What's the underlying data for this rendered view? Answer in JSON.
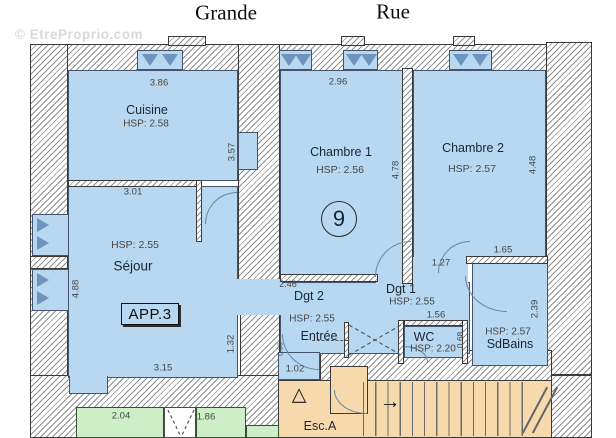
{
  "watermark": "© EtreProprio.com",
  "streets": {
    "left": "Grande",
    "right": "Rue"
  },
  "unit": {
    "app_label": "APP.3",
    "number": "9"
  },
  "rooms": {
    "cuisine": {
      "name": "Cuisine",
      "hsp": "HSP: 2.58"
    },
    "sejour": {
      "name": "Séjour",
      "hsp": "HSP: 2.55"
    },
    "chambre1": {
      "name": "Chambre 1",
      "hsp": "HSP: 2.56"
    },
    "chambre2": {
      "name": "Chambre 2",
      "hsp": "HSP: 2.57"
    },
    "dgt2": {
      "name": "Dgt 2",
      "hsp": "HSP: 2.55"
    },
    "dgt1": {
      "name": "Dgt 1",
      "hsp": "HSP: 2.55"
    },
    "entree": {
      "name": "Entrée"
    },
    "wc": {
      "name": "WC",
      "hsp": "HSP: 2.20"
    },
    "sdbains": {
      "name": "SdBains",
      "hsp": "HSP: 2.57"
    },
    "escalier": {
      "name": "Esc.A"
    }
  },
  "dimensions": {
    "cuisine_width": "3.86",
    "cuisine_depth": "3.57",
    "sejour_top_width": "3.01",
    "sejour_height": "4.88",
    "sejour_bottom_width": "3.15",
    "sejour_right": "1.32",
    "chambre1_width": "2.96",
    "chambre1_height": "4.78",
    "chambre2_height": "4.48",
    "dgt2_width": "2.46",
    "dgt1_wall": "1.27",
    "sdbains_width": "1.65",
    "wc_width": "1.56",
    "wc_right": "0.68",
    "sdbains_height": "2.39",
    "entree_bottom": "1.02",
    "entree_door": "0.96",
    "annex_left_width": "2.04",
    "annex_right_width": "1.86"
  },
  "icons": {
    "stair_arrow": "→",
    "stair_start": "△"
  },
  "colors": {
    "room_fill": "#b8d7f0",
    "annex_fill": "#cdeec6",
    "stair_fill": "#f7d9ae",
    "wall_hatch": "#8f8f8f"
  }
}
